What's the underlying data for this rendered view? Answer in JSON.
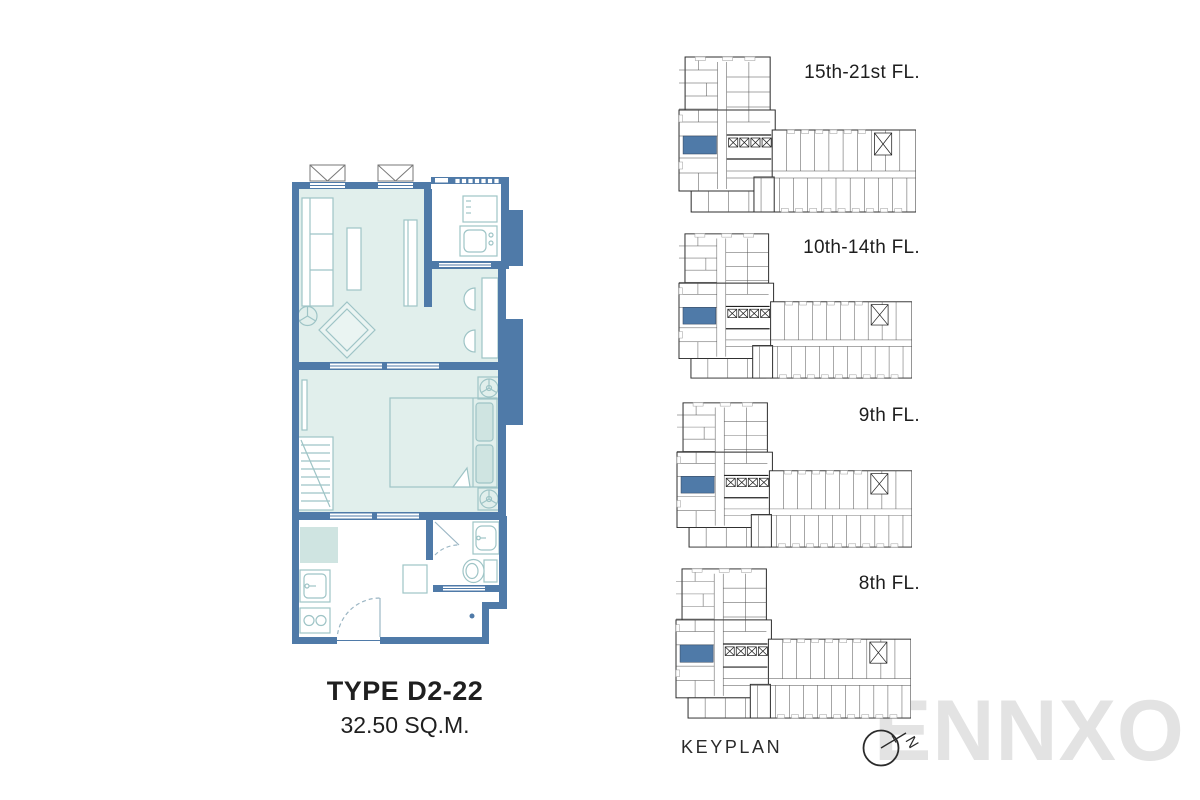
{
  "sheet": {
    "unit_type": "TYPE D2-22",
    "unit_area": "32.50 SQ.M.",
    "keyplan_caption": "KEYPLAN",
    "compass_letter": "N",
    "watermark": "ENNXO"
  },
  "keyplans": [
    {
      "label": "15th-21st FL."
    },
    {
      "label": "10th-14th FL."
    },
    {
      "label": "9th FL."
    },
    {
      "label": "8th FL."
    }
  ],
  "colors": {
    "wall_blue": "#4f7aa8",
    "floor_teal": "#e1efec",
    "furniture_line": "#9ec4c6",
    "accent_fill": "#cfe4e1",
    "highlight_unit_blue": "#4f7aa8",
    "keyplan_line": "#2e2e2e",
    "text": "#1e1e1e",
    "watermark_gray": "#e3e3e3"
  }
}
